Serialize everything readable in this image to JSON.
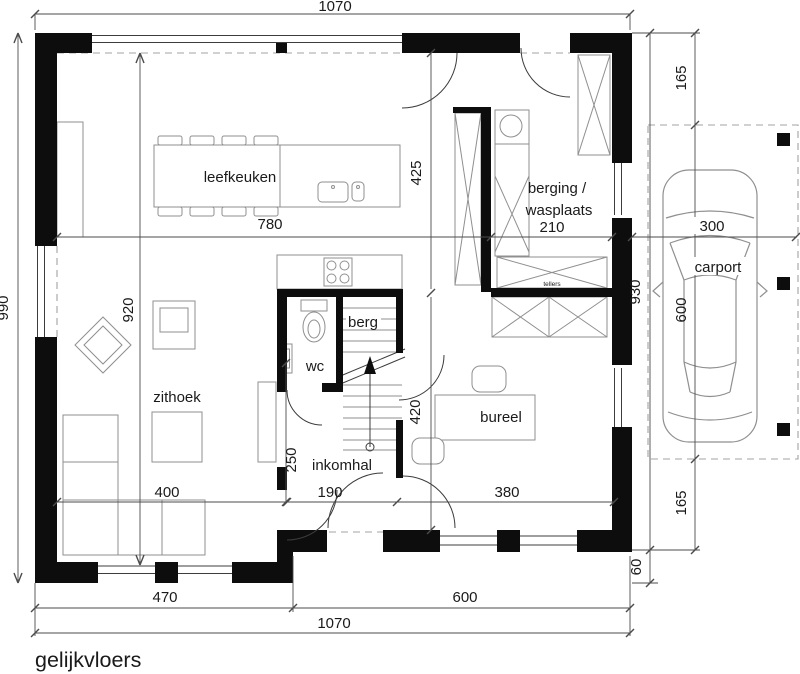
{
  "title": "gelijkvloers",
  "rooms": {
    "leefkeuken": "leefkeuken",
    "zithoek": "zithoek",
    "wc": "wc",
    "berg": "berg",
    "inkomhal": "inkomhal",
    "bureel": "bureel",
    "berging_line1": "berging /",
    "berging_line2": "wasplaats",
    "carport": "carport",
    "tellers": "tellers"
  },
  "dimensions": {
    "top_total": "1070",
    "left_total": "990",
    "kitchen_width": "780",
    "kitchen_depth": "425",
    "berging_width": "210",
    "living_depth": "920",
    "zithoek_width": "400",
    "inkomhal_width": "190",
    "inkomhal_depth": "250",
    "bureel_width": "380",
    "bureel_depth": "420",
    "bottom_left": "470",
    "bottom_right": "600",
    "bottom_total": "1070",
    "right_offset_top": "165",
    "house_depth": "930",
    "wall_ledge": "60",
    "carport_width": "300",
    "carport_length": "600",
    "right_offset_bottom": "165"
  },
  "colors": {
    "wall": "#0d0d0d",
    "line": "#3c3c3c",
    "furniture": "#8f8f8f",
    "dim": "#4b4b4b",
    "dashed": "#a3a3a3",
    "text": "#1a1a1a"
  }
}
